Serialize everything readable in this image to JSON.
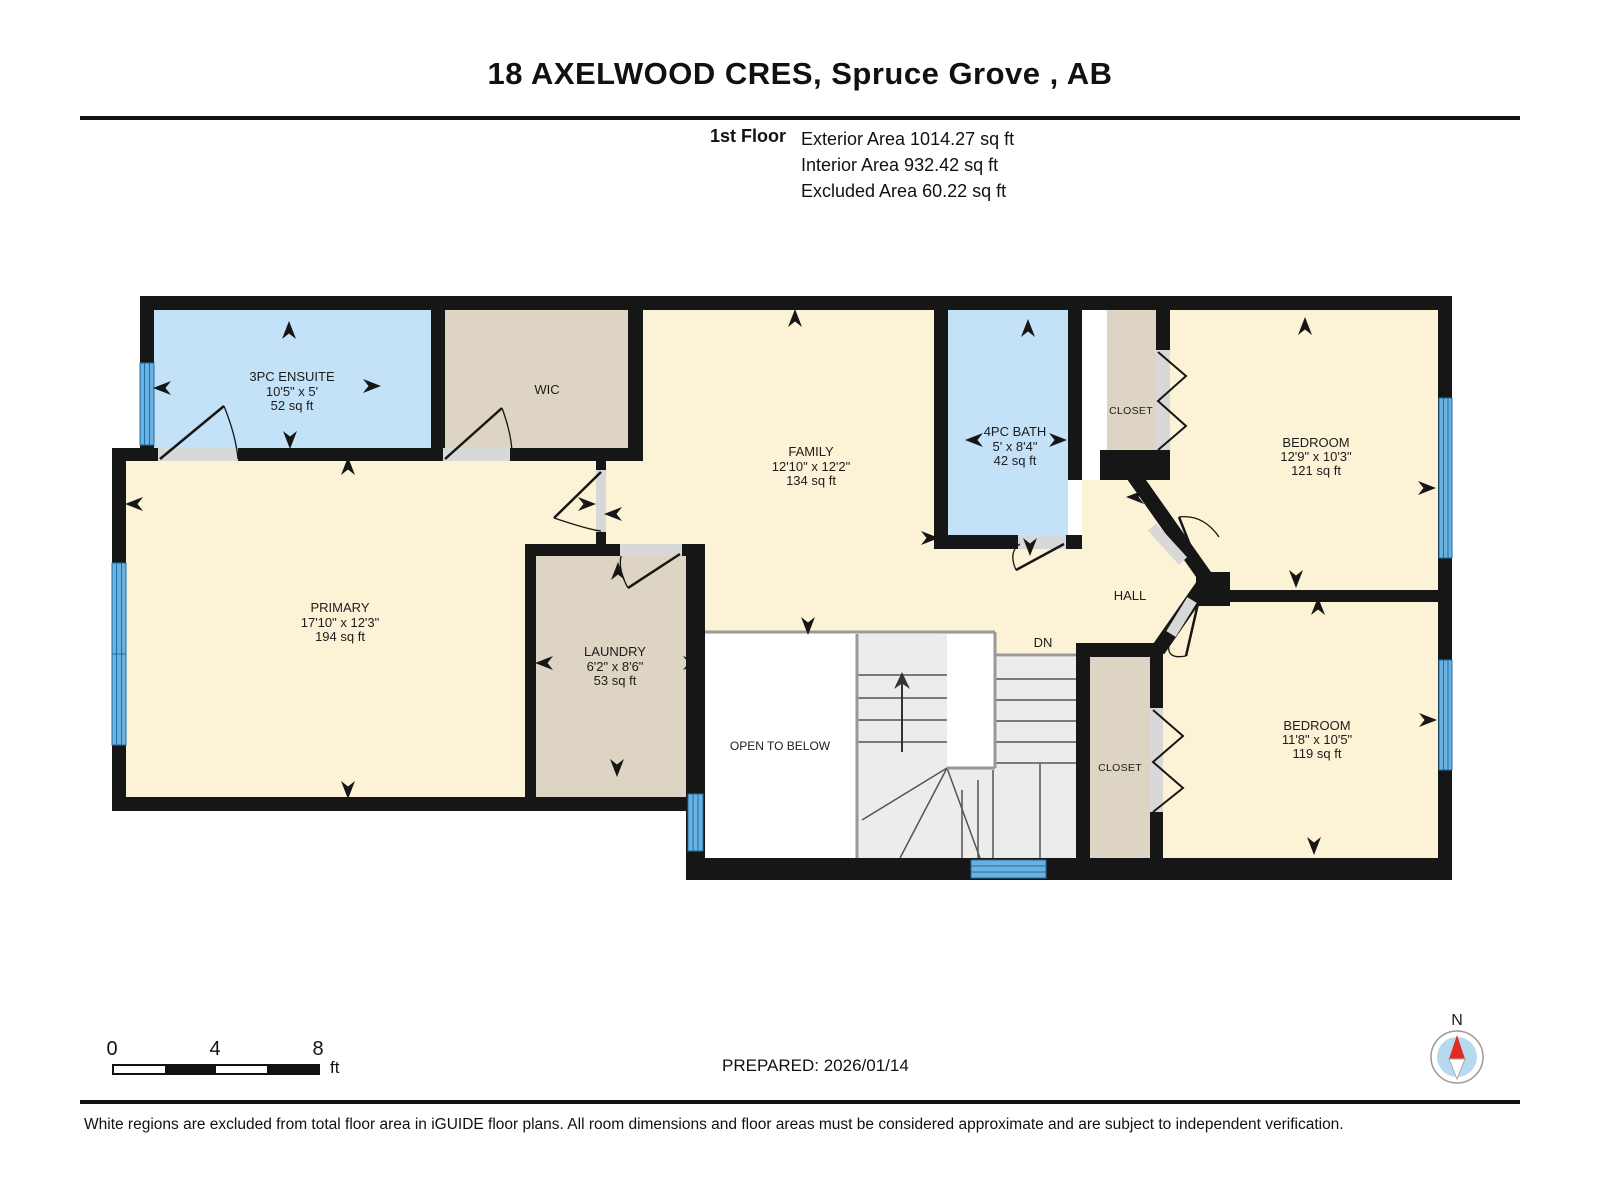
{
  "header": {
    "title": "18 AXELWOOD CRES, Spruce Grove , AB",
    "floor_label": "1st Floor",
    "exterior_area": "Exterior Area 1014.27 sq ft",
    "interior_area": "Interior Area 932.42 sq ft",
    "excluded_area": "Excluded Area 60.22 sq ft"
  },
  "plan": {
    "rooms": {
      "ensuite": {
        "name": "3PC ENSUITE",
        "dims": "10'5\" x 5'",
        "area": "52 sq ft"
      },
      "wic": {
        "name": "WIC"
      },
      "family": {
        "name": "FAMILY",
        "dims": "12'10\" x 12'2\"",
        "area": "134 sq ft"
      },
      "bath": {
        "name": "4PC BATH",
        "dims": "5' x 8'4\"",
        "area": "42 sq ft"
      },
      "closet_top": {
        "name": "CLOSET"
      },
      "bedroom_top": {
        "name": "BEDROOM",
        "dims": "12'9\" x 10'3\"",
        "area": "121 sq ft"
      },
      "primary": {
        "name": "PRIMARY",
        "dims": "17'10\" x 12'3\"",
        "area": "194 sq ft"
      },
      "laundry": {
        "name": "LAUNDRY",
        "dims": "6'2\" x 8'6\"",
        "area": "53 sq ft"
      },
      "open_below": {
        "name": "OPEN TO BELOW"
      },
      "stairs_down": {
        "name": "DN"
      },
      "hall": {
        "name": "HALL"
      },
      "closet_bottom": {
        "name": "CLOSET"
      },
      "bedroom_bottom": {
        "name": "BEDROOM",
        "dims": "11'8\" x 10'5\"",
        "area": "119 sq ft"
      }
    }
  },
  "footer": {
    "scale": {
      "ticks": [
        "0",
        "4",
        "8"
      ],
      "unit": "ft"
    },
    "prepared": "PREPARED: 2026/01/14",
    "compass_north_label": "N",
    "disclaimer": "White regions are excluded from total floor area in iGUIDE floor plans. All room dimensions and floor areas must be considered approximate and are subject to independent verification."
  },
  "colors": {
    "cream": "#fcf2d6",
    "tan": "#ddd4c3",
    "blue": "#c3e2f7",
    "window": "#6ab1e0",
    "window_line": "#1d6fa8",
    "wall": "#161616",
    "sill": "#d8d8d8",
    "stair": "#ececec",
    "white": "#ffffff",
    "compass_red": "#e02b20",
    "compass_blue": "#b7d9f0"
  }
}
